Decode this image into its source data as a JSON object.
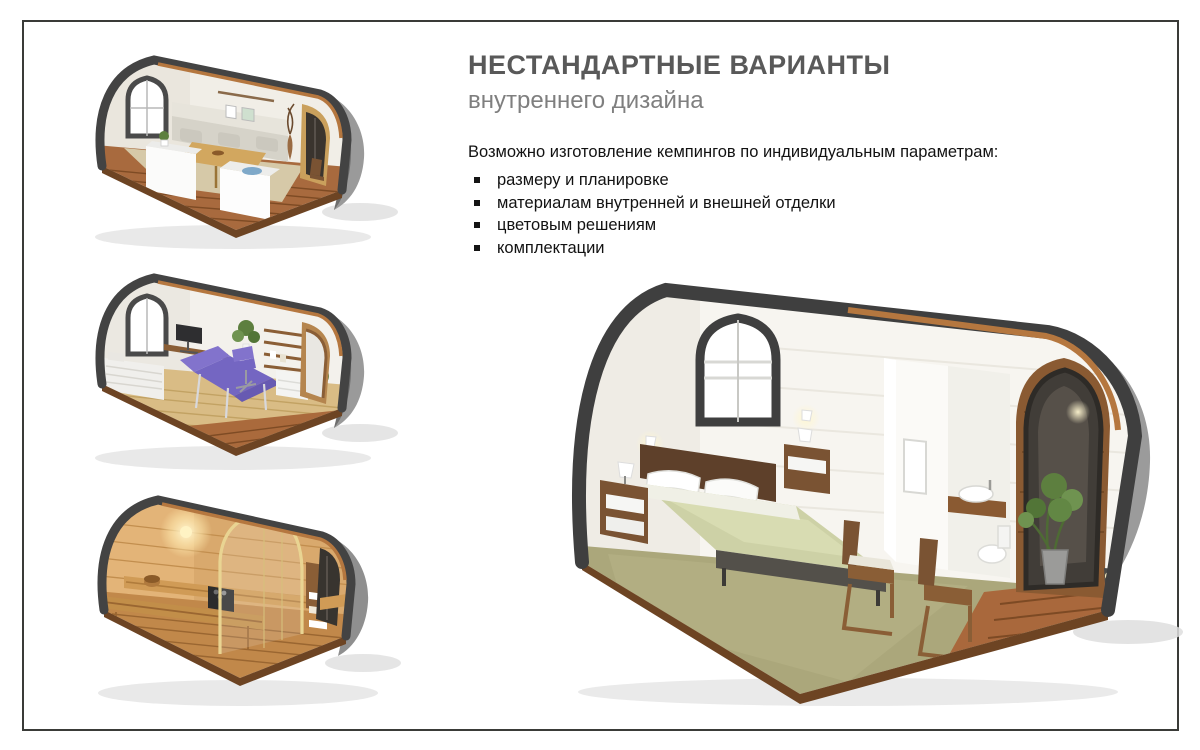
{
  "slide": {
    "title": "НЕСТАНДАРТНЫЕ ВАРИАНТЫ",
    "subtitle": "внутреннего дизайна",
    "intro": "Возможно изготовление кемпингов по индивидуальным параметрам:",
    "bullets": [
      "размеру и планировке",
      "материалам внутренней и внешней отделки",
      "цветовым решениям",
      "комплектации"
    ],
    "illustrations": [
      {
        "alt": "Кемпинг-модуль: гостиная с диваном и обеденным столом"
      },
      {
        "alt": "Кемпинг-модуль: массажный кабинет с фиолетовой кушеткой"
      },
      {
        "alt": "Кемпинг-модуль: деревянная сауна"
      },
      {
        "alt": "Кемпинг-модуль: спальня с санузлом"
      }
    ],
    "colors": {
      "title": "#595959",
      "subtitle": "#7f7f7f",
      "body_text": "#121212",
      "frame_border": "#3a3b38",
      "pod_rim": "#434343",
      "pod_wood_edge": "#b5773f",
      "deck_wood": "#a9683c",
      "interior_wall": "#f4f2ec",
      "accent_purple": "#8273cc",
      "sauna_wood": "#d9a96d",
      "carpet_green": "#aba77b",
      "bedding_sage": "#cdd1a6"
    }
  }
}
